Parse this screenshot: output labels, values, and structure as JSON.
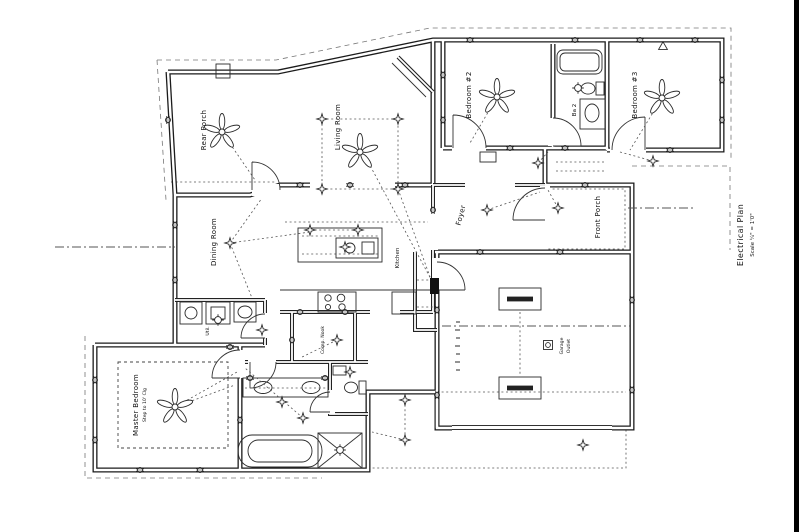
{
  "title_block": {
    "line1": "Electrical Plan",
    "line2": "Scale ¼\" = 1'0\""
  },
  "rooms": {
    "rear_porch": "Rear Porch",
    "living_room": "Living Room",
    "bedroom2": "Bedroom #2",
    "bath2": "Ba 2",
    "bedroom3": "Bedroom #3",
    "foyer": "Foyer",
    "front_porch": "Front Porch",
    "dining_room": "Dining Room",
    "kitchen": "Kitchen",
    "utility": "Util.",
    "comp_nook": "Comp. Nook",
    "master_bedroom": "Master Bedroom",
    "master_bedroom_note": "Step to 10' Clg",
    "garage_outlet_line1": "Garage",
    "garage_outlet_line2": "Outlet"
  },
  "symbols": {
    "ceiling_fan": "ceiling-fan-icon",
    "recessed_light": "recessed-light-icon",
    "ceiling_light": "ceiling-light-icon",
    "duplex_outlet": "duplex-outlet-icon",
    "switch": "$",
    "fluorescent_fixture": "fluorescent-fixture-icon",
    "smoke_detector": "smoke-detector-icon",
    "electrical_panel": "electrical-panel-icon"
  },
  "colors": {
    "ink": "#1b1b1b",
    "paper": "#ffffff",
    "dashed": "#555555",
    "edge_bar": "#000000"
  }
}
